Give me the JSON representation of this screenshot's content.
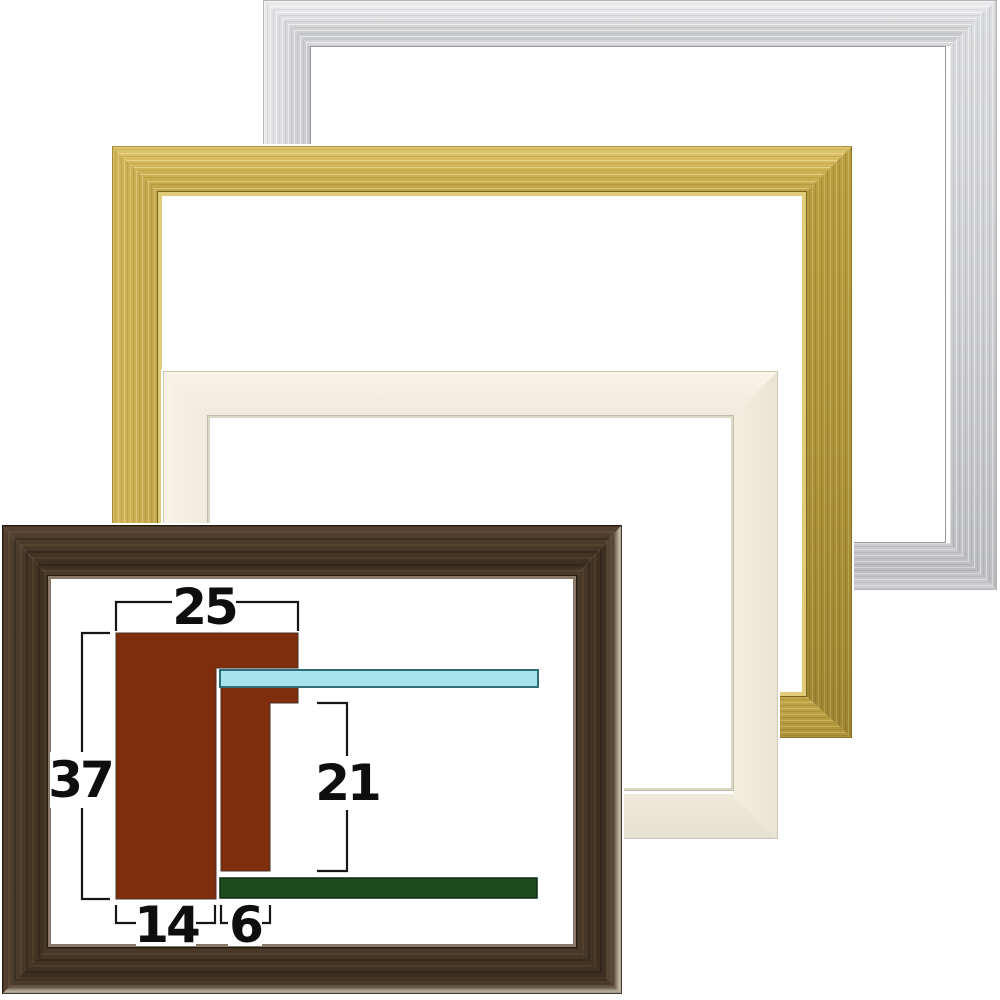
{
  "image": {
    "background": "#ffffff",
    "description": "Four empty picture frames overlapped, with moulding cross-section dimension diagram inside the dark brown frame"
  },
  "frames": {
    "silver": {
      "name": "silver frame",
      "base_color": "#d3d4d6"
    },
    "gold": {
      "name": "gold frame",
      "base_color": "#c9ad4d"
    },
    "cream": {
      "name": "cream frame",
      "base_color": "#f3eee0"
    },
    "dark_brown": {
      "name": "dark brown wood frame",
      "base_color": "#46362a"
    }
  },
  "diagram": {
    "labels": {
      "top_width": "25",
      "left_height": "37",
      "right_inner_height": "21",
      "bottom_left_width": "14",
      "bottom_right_width": "6"
    },
    "colors": {
      "moulding": "#802d0d",
      "glass": "#a7e3ed",
      "glass_border": "#2d6e79",
      "backboard": "#1d4b1e",
      "backboard_border": "#0e2d10",
      "line": "#161616",
      "text": "#0e0e0e"
    }
  }
}
